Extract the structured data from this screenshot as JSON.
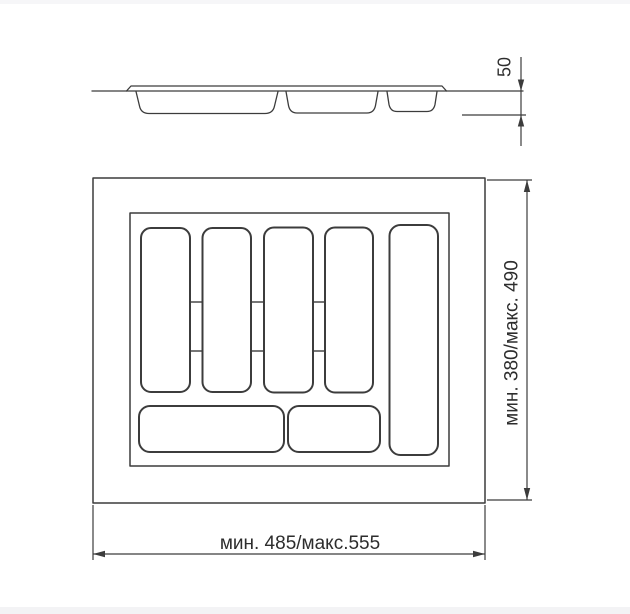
{
  "drawing": {
    "description": "cutlery-tray-technical-drawing",
    "side_view": {
      "depth_dimension": "50"
    },
    "top_view": {
      "width_dimension": "мин. 485/макс.555",
      "height_dimension": "мин. 380/макс. 490"
    },
    "colors": {
      "line": "#3c3c3c",
      "text": "#2d2d2d",
      "background": "#ffffff",
      "page_edge_strip": "#f5f5f7"
    }
  }
}
